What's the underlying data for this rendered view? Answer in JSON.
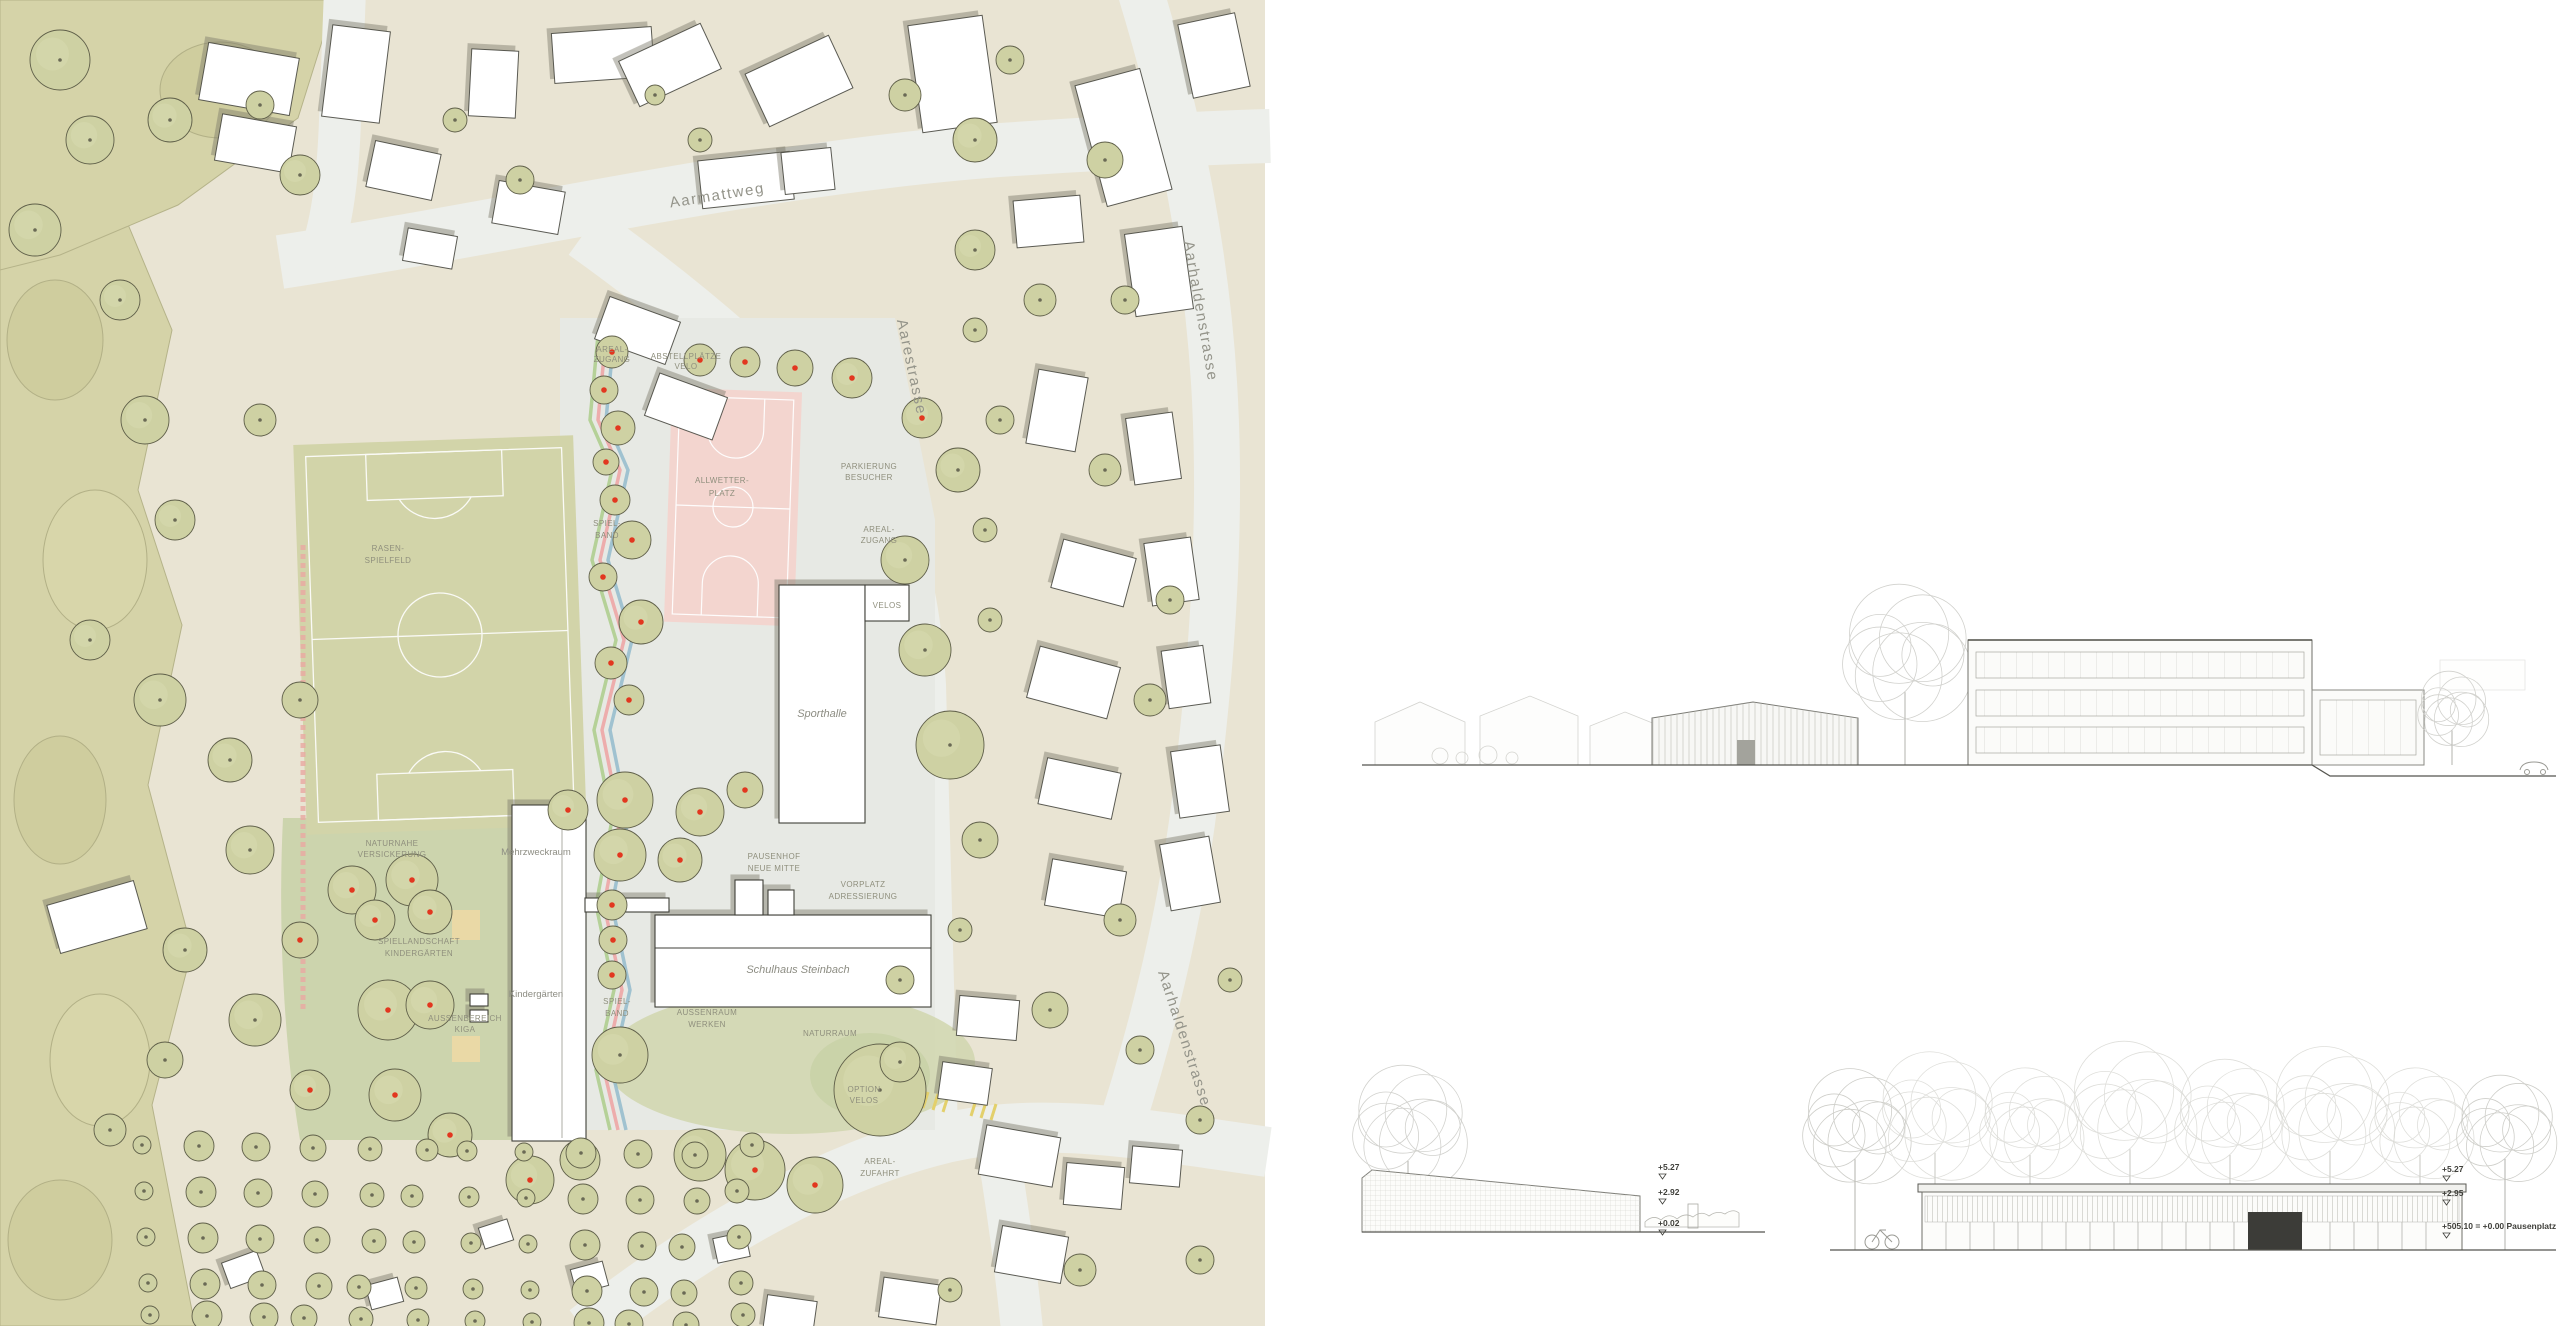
{
  "title": "Schulanlage Steinbach – Situationsplan und Ansichten",
  "site_plan": {
    "streets": {
      "aarmattweg": "Aarmattweg",
      "aarestrasse": "Aarestrasse",
      "aarhaldenstrasse_north": "Aarhaldenstrasse",
      "aarhaldenstrasse_south": "Aarhaldenstrasse"
    },
    "buildings": {
      "sporthalle": "Sporthalle",
      "mehrzweckraum": "Mehrzweckraum",
      "kindergaerten": "Kindergärten",
      "schulhaus": "Schulhaus Steinbach"
    },
    "areas": {
      "areal_zugang_1": "AREAL-",
      "areal_zugang_2": "ZUGANG",
      "velo_1": "ABSTELLPLÄTZE",
      "velo_2": "VELO",
      "parkierung_1": "PARKIERUNG",
      "parkierung_2": "BESUCHER",
      "areal_zugang2_1": "AREAL-",
      "areal_zugang2_2": "ZUGANG",
      "velos": "VELOS",
      "rasen_1": "RASEN-",
      "rasen_2": "SPIELFELD",
      "allwetter_1": "ALLWETTER-",
      "allwetter_2": "PLATZ",
      "spielband_1": "SPIEL-",
      "spielband_2": "BAND",
      "spielband2_1": "SPIEL-",
      "spielband2_2": "BAND",
      "versickerung_1": "NATURNAHE",
      "versickerung_2": "VERSICKERUNG",
      "spiellandschaft_1": "SPIELLANDSCHAFT",
      "spiellandschaft_2": "KINDERGÄRTEN",
      "aussenbereich_1": "AUSSENBEREICH",
      "aussenbereich_2": "KIGA",
      "pausenhof_1": "PAUSENHOF",
      "pausenhof_2": "NEUE MITTE",
      "vorplatz_1": "VORPLATZ",
      "vorplatz_2": "ADRESSIERUNG",
      "aussenraum_1": "AUSSENRAUM",
      "aussenraum_2": "WERKEN",
      "naturraum": "NATURRAUM",
      "option_1": "OPTION",
      "option_2": "VELOS",
      "zufahrt_1": "AREAL-",
      "zufahrt_2": "ZUFAHRT"
    },
    "colors": {
      "paper": "#e9e4d3",
      "road": "#edefeb",
      "plaza": "#e7e9e4",
      "field_green": "#d2d4a9",
      "forest_green": "#d5d3a8",
      "tree_fill": "#ced1a3",
      "court_pink": "#f3d5cf",
      "new_tree_dot": "#e2371f",
      "sand": "#ead9a6"
    }
  },
  "elevations": {
    "bottom_left": {
      "m1": "+5.27",
      "m2": "+2.92",
      "m3": "+0.02"
    },
    "bottom_right": {
      "m1": "+5.27",
      "m2": "+2.95",
      "m3": "+505.10 = +0.00 Pausenplatz"
    }
  }
}
